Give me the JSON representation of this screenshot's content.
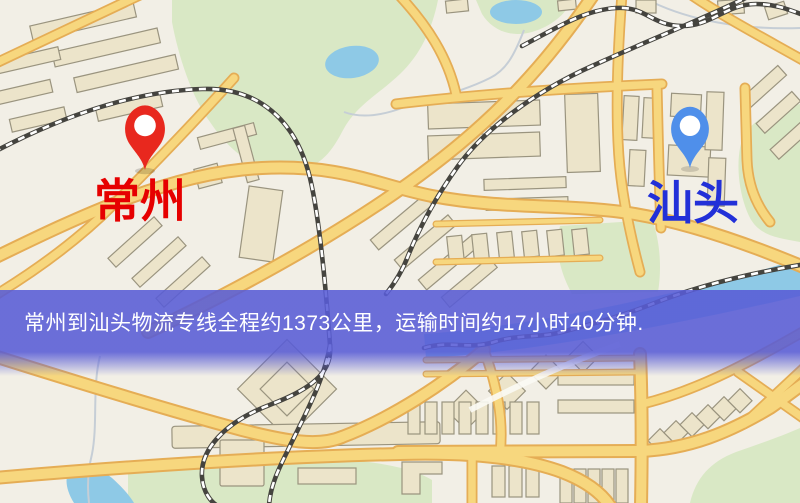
{
  "map": {
    "origin": {
      "label": "常州"
    },
    "destination": {
      "label": "汕头"
    },
    "colors": {
      "background": "#f2efe6",
      "road_fill": "#f7d77e",
      "road_casing": "#e5ad55",
      "railway": "#45443f",
      "park": "#d9e8c5",
      "water": "#8ec9e6",
      "building": "#ece4ca",
      "origin_pin": "#e8281e",
      "origin_label": "#e60000",
      "destination_pin": "#4f8fea",
      "destination_label": "#2230d8"
    }
  },
  "banner": {
    "text": "常州到汕头物流专线全程约1373公里，运输时间约17小时40分钟.",
    "distance": "约1373公里",
    "duration": "约17小时40分钟",
    "background": "#585cd6",
    "text_color": "#ffffff"
  }
}
